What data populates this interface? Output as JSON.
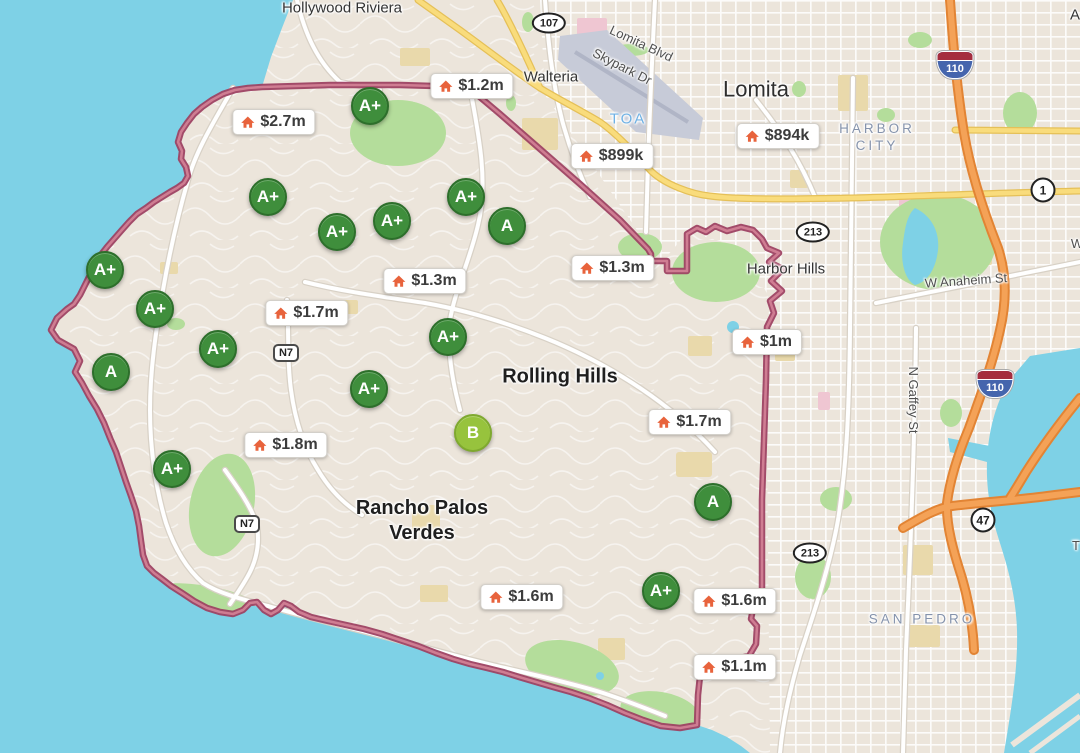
{
  "map_title": "Palos Verdes area schools and home prices map",
  "colors": {
    "water": "#7ed1e6",
    "land": "#ece5db",
    "park": "#b4dd9b",
    "boundary": "#a04768",
    "badge_green": "#3f8e3c",
    "badge_b_green": "#97c33d",
    "price_icon_orange": "#e8633c",
    "freeway_orange": "#f4a257",
    "highway_yellow": "#f8d977",
    "district_label": "#8593ac"
  },
  "place_labels": [
    {
      "text": "Hollywood Riviera",
      "type": "town",
      "x": 342,
      "y": 9,
      "angle": 0
    },
    {
      "text": "Walteria",
      "type": "town",
      "x": 551,
      "y": 78,
      "angle": 0
    },
    {
      "text": "Lomita",
      "type": "city",
      "x": 756,
      "y": 89,
      "angle": 0
    },
    {
      "text": "TOA",
      "type": "airport",
      "x": 628,
      "y": 120,
      "angle": 0
    },
    {
      "text": "HARBOR CITY",
      "lines": [
        "HARBOR",
        "CITY"
      ],
      "type": "district",
      "x": 877,
      "y": 138,
      "angle": 0
    },
    {
      "text": "Harbor Hills",
      "type": "town",
      "x": 786,
      "y": 270,
      "angle": 0
    },
    {
      "text": "Rolling Hills",
      "type": "area",
      "x": 560,
      "y": 377,
      "angle": 0
    },
    {
      "text": "Rancho Palos Verdes",
      "lines": [
        "Rancho Palos",
        "Verdes"
      ],
      "type": "area",
      "x": 422,
      "y": 521,
      "angle": 0
    },
    {
      "text": "SAN PEDRO",
      "type": "district",
      "x": 922,
      "y": 620,
      "angle": 0
    },
    {
      "text": "A",
      "type": "town",
      "x": 1075,
      "y": 16,
      "angle": 0
    }
  ],
  "road_labels": [
    {
      "text": "Lomita Blvd",
      "x": 641,
      "y": 44,
      "angle": 25
    },
    {
      "text": "Skypark Dr",
      "x": 622,
      "y": 67,
      "angle": 27
    },
    {
      "text": "W Anaheim St",
      "x": 966,
      "y": 281,
      "angle": -4
    },
    {
      "text": "N Gaffey St",
      "x": 913,
      "y": 400,
      "angle": 90
    },
    {
      "text": "W",
      "x": 1077,
      "y": 244,
      "angle": 0
    },
    {
      "text": "T",
      "x": 1076,
      "y": 546,
      "angle": 0
    }
  ],
  "route_shields": [
    {
      "number": "107",
      "type": "oval",
      "x": 549,
      "y": 23
    },
    {
      "number": "213",
      "type": "oval",
      "x": 813,
      "y": 232
    },
    {
      "number": "213",
      "type": "oval",
      "x": 810,
      "y": 553
    },
    {
      "number": "1",
      "type": "circle",
      "x": 1043,
      "y": 190
    },
    {
      "number": "47",
      "type": "circle",
      "x": 983,
      "y": 520
    },
    {
      "number": "110",
      "type": "interstate",
      "x": 955,
      "y": 65
    },
    {
      "number": "110",
      "type": "interstate",
      "x": 995,
      "y": 384
    },
    {
      "number": "N7",
      "type": "rect",
      "x": 286,
      "y": 353
    },
    {
      "number": "N7",
      "type": "rect",
      "x": 247,
      "y": 524
    }
  ],
  "rating_badges": [
    {
      "grade": "A+",
      "x": 370,
      "y": 106
    },
    {
      "grade": "A+",
      "x": 268,
      "y": 197
    },
    {
      "grade": "A+",
      "x": 337,
      "y": 232
    },
    {
      "grade": "A+",
      "x": 392,
      "y": 221
    },
    {
      "grade": "A+",
      "x": 466,
      "y": 197
    },
    {
      "grade": "A",
      "x": 507,
      "y": 226
    },
    {
      "grade": "A+",
      "x": 105,
      "y": 270
    },
    {
      "grade": "A+",
      "x": 155,
      "y": 309
    },
    {
      "grade": "A+",
      "x": 218,
      "y": 349
    },
    {
      "grade": "A",
      "x": 111,
      "y": 372
    },
    {
      "grade": "A+",
      "x": 448,
      "y": 337
    },
    {
      "grade": "A+",
      "x": 369,
      "y": 389
    },
    {
      "grade": "B",
      "x": 473,
      "y": 433
    },
    {
      "grade": "A+",
      "x": 172,
      "y": 469
    },
    {
      "grade": "A",
      "x": 713,
      "y": 502
    },
    {
      "grade": "A+",
      "x": 661,
      "y": 591
    }
  ],
  "price_markers": [
    {
      "price": "$1.2m",
      "x": 472,
      "y": 86
    },
    {
      "price": "$2.7m",
      "x": 274,
      "y": 122
    },
    {
      "price": "$899k",
      "x": 612,
      "y": 156
    },
    {
      "price": "$894k",
      "x": 778,
      "y": 136
    },
    {
      "price": "$1.3m",
      "x": 613,
      "y": 268
    },
    {
      "price": "$1.3m",
      "x": 425,
      "y": 281
    },
    {
      "price": "$1.7m",
      "x": 307,
      "y": 313
    },
    {
      "price": "$1m",
      "x": 767,
      "y": 342
    },
    {
      "price": "$1.7m",
      "x": 690,
      "y": 422
    },
    {
      "price": "$1.8m",
      "x": 286,
      "y": 445
    },
    {
      "price": "$1.6m",
      "x": 522,
      "y": 597
    },
    {
      "price": "$1.6m",
      "x": 735,
      "y": 601
    },
    {
      "price": "$1.1m",
      "x": 735,
      "y": 667
    }
  ]
}
